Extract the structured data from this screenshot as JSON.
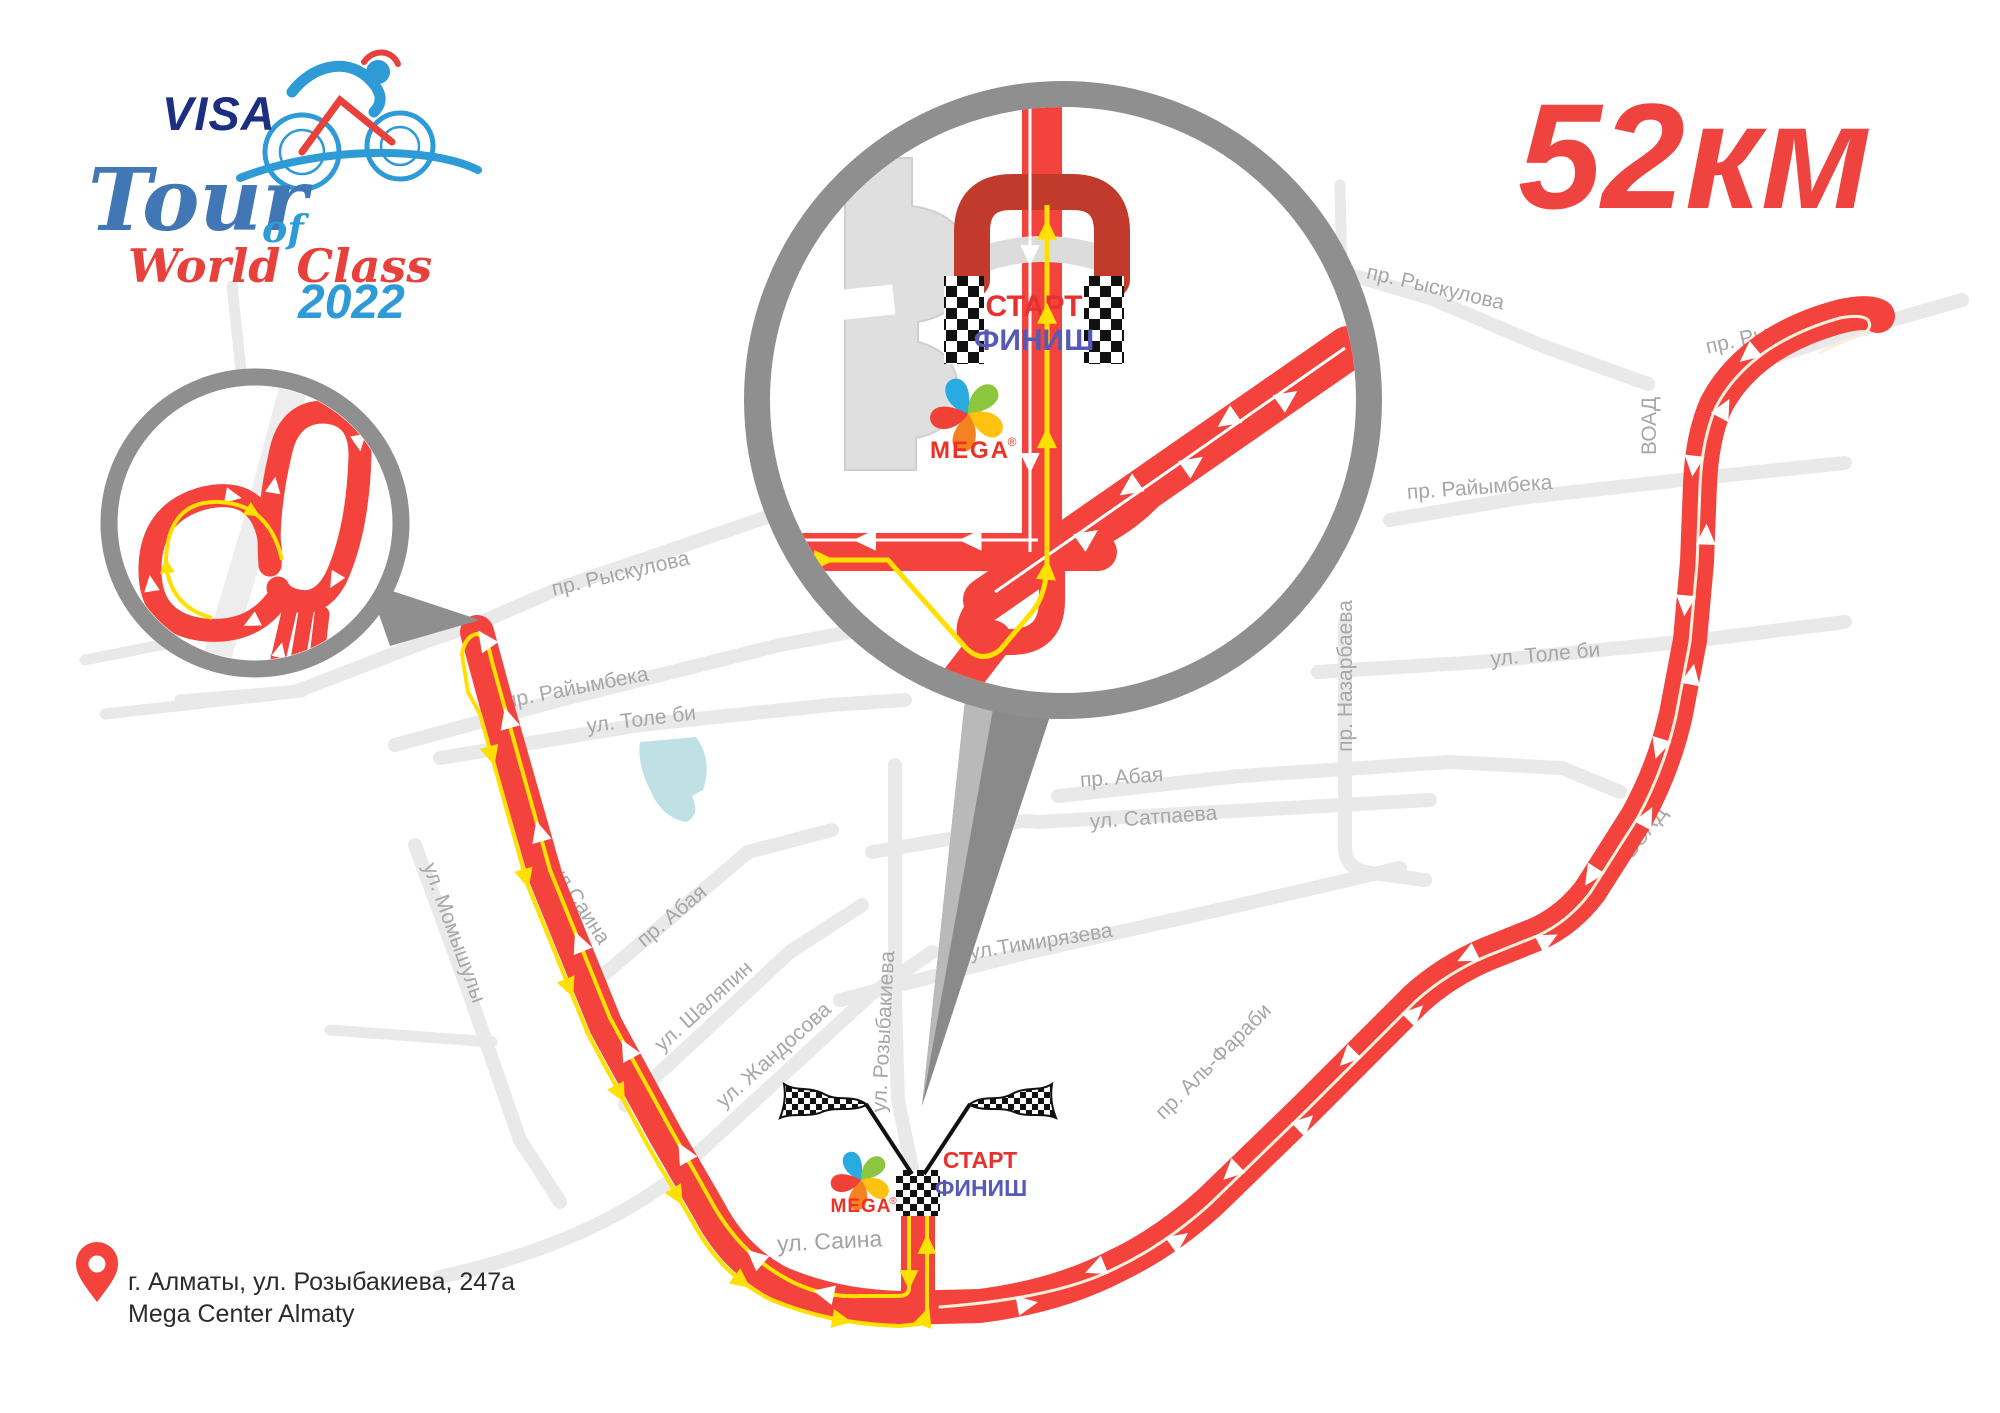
{
  "logo": {
    "visa": "VISA",
    "tour": "Tour",
    "of": "of",
    "world_class": "World Class",
    "year": "2022"
  },
  "distance_label": "52км",
  "labels": {
    "start": "СТАРТ",
    "finish": "ФИНИШ",
    "mega": "MEGA",
    "mega_reg": "®"
  },
  "address": {
    "line1": "г. Алматы, ул. Розыбакиева, 247а",
    "line2": "Mega Center Almaty"
  },
  "streets": {
    "ryskulova_w": "пр. Рыскулова",
    "ryskulova_ne": "пр. Рыскулова",
    "ryskulova_e": "пр. Рыскулова",
    "raiymbeka_w": "пр. Райымбека",
    "raiymbeka_e": "пр. Райымбека",
    "tolebi_w": "ул. Толе би",
    "tolebi_e": "ул. Толе би",
    "abaya_w": "пр. Абая",
    "abaya_e": "пр. Абая",
    "satpaeva": "ул. Сатпаева",
    "timiryazeva": "ул.Тимирязева",
    "alfarabi": "пр. Аль-Фараби",
    "voad_vertical": "ВОАД",
    "voad_diagonal": "ВОАД",
    "momyshuly": "ул. Момышулы",
    "saina_diagonal": "ул.Саина",
    "saina_bottom": "ул. Саина",
    "shalyapin": "ул. Шаляпин",
    "zhandosova": "ул. Жандосова",
    "rozybakieva": "ул. Розыбакиева",
    "nazarbaeva": "пр. Назарбаева"
  },
  "colors": {
    "route_red": "#F4433C",
    "gantry_dark_red": "#C23A2C",
    "direction_yellow": "#FFE000",
    "street_gray": "#E9E9E9",
    "street_label_gray": "#A7A7A7",
    "inset_ring_gray": "#8F8F8F",
    "distance_red": "#EF4340",
    "start_red": "#E8312E",
    "finish_blue": "#5659B5",
    "pond_blue": "#BFE1E5",
    "mega_red": "#EE3124",
    "visa_navy": "#1B2E80",
    "logo_blue": "#4077B4",
    "logo_light_blue": "#2E9BD6",
    "logo_script_red": "#E8413C"
  }
}
